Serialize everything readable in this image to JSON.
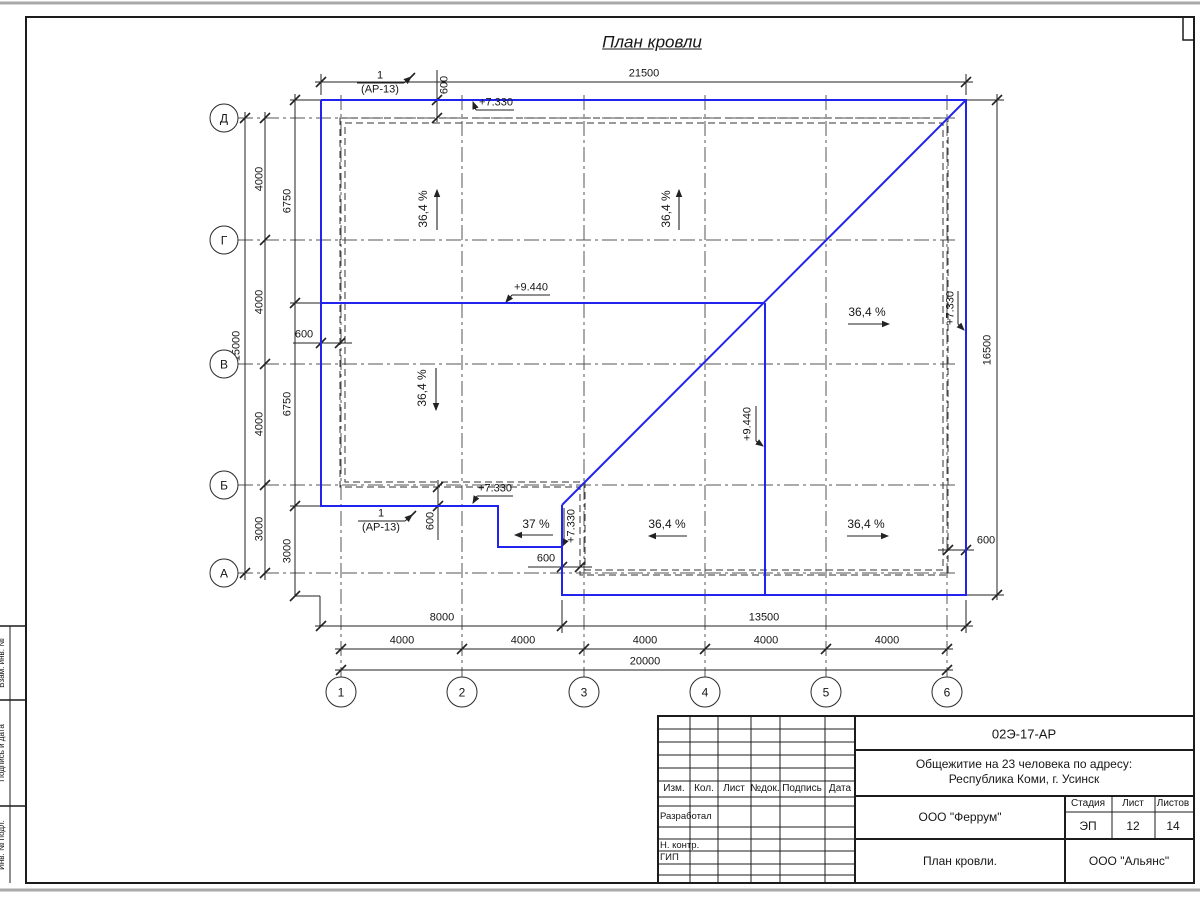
{
  "sheet": {
    "title": "План кровли",
    "margin_labels": [
      "Взам. инв. №",
      "Подпись и дата",
      "Инв. № подл."
    ]
  },
  "axes": {
    "rows": [
      "Д",
      "Г",
      "В",
      "Б",
      "А"
    ],
    "cols": [
      "1",
      "2",
      "3",
      "4",
      "5",
      "6"
    ]
  },
  "dims": {
    "top_total": "21500",
    "right_total": "16500",
    "left_col1": [
      "4000",
      "4000",
      "4000",
      "3000"
    ],
    "left_total": "15000",
    "left_col2": [
      "6750",
      "6750",
      "3000"
    ],
    "offset_600": "600",
    "bottom_row1": [
      "8000",
      "13500"
    ],
    "bottom_row2": [
      "4000",
      "4000",
      "4000",
      "4000",
      "4000"
    ],
    "bottom_total": "20000"
  },
  "marks": {
    "eave_elev": "+7.330",
    "ridge_elev": "+9.440",
    "slope_main": "36,4 %",
    "slope_small": "37 %",
    "callout_num": "1",
    "callout_ref": "(АР-13)"
  },
  "titleblock": {
    "doc_code": "02Э-17-АР",
    "project_line1": "Общежитие на 23 человека по адресу:",
    "project_line2": "Республика Коми, г. Усинск",
    "header_cols": [
      "Изм.",
      "Кол.",
      "Лист",
      "№док.",
      "Подпись",
      "Дата"
    ],
    "role_rows": [
      "Разработал",
      "Н. контр.",
      "ГИП"
    ],
    "designer_org": "ООО \"Феррум\"",
    "sheet_name": "План кровли.",
    "client_org": "ООО \"Альянс\"",
    "stage_label": "Стадия",
    "sheet_label": "Лист",
    "sheets_label": "Листов",
    "stage": "ЭП",
    "sheet_no": "12",
    "sheets_total": "14"
  }
}
